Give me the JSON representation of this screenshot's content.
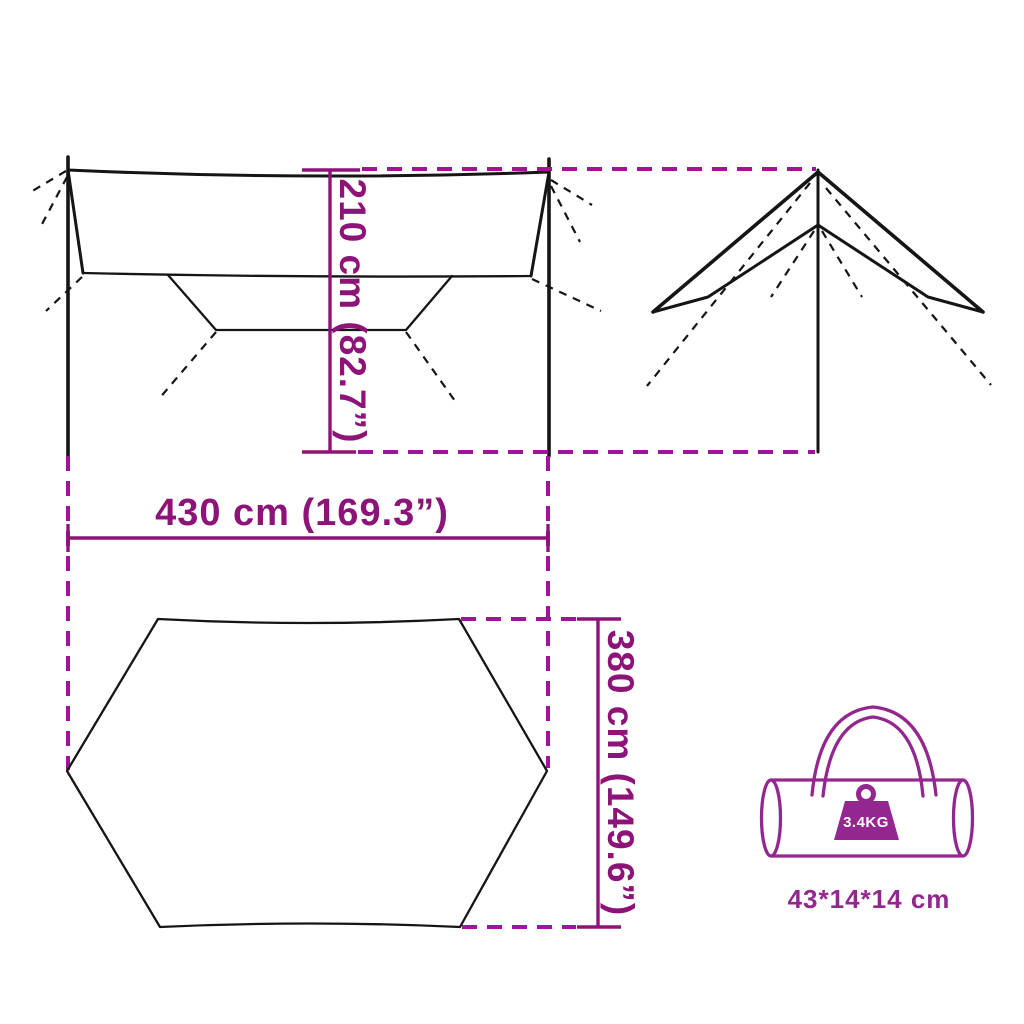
{
  "colors": {
    "line": "#151515",
    "dim": "#8d1379",
    "dimDash": "#a2139b",
    "bag": "#93278f",
    "onBag": "#ffffff"
  },
  "dimensions": {
    "height": "210 cm (82.7”)",
    "width": "430 cm (169.3”)",
    "depth": "380 cm (149.6”)"
  },
  "bag": {
    "weight": "3.4KG",
    "size": "43*14*14 cm"
  }
}
